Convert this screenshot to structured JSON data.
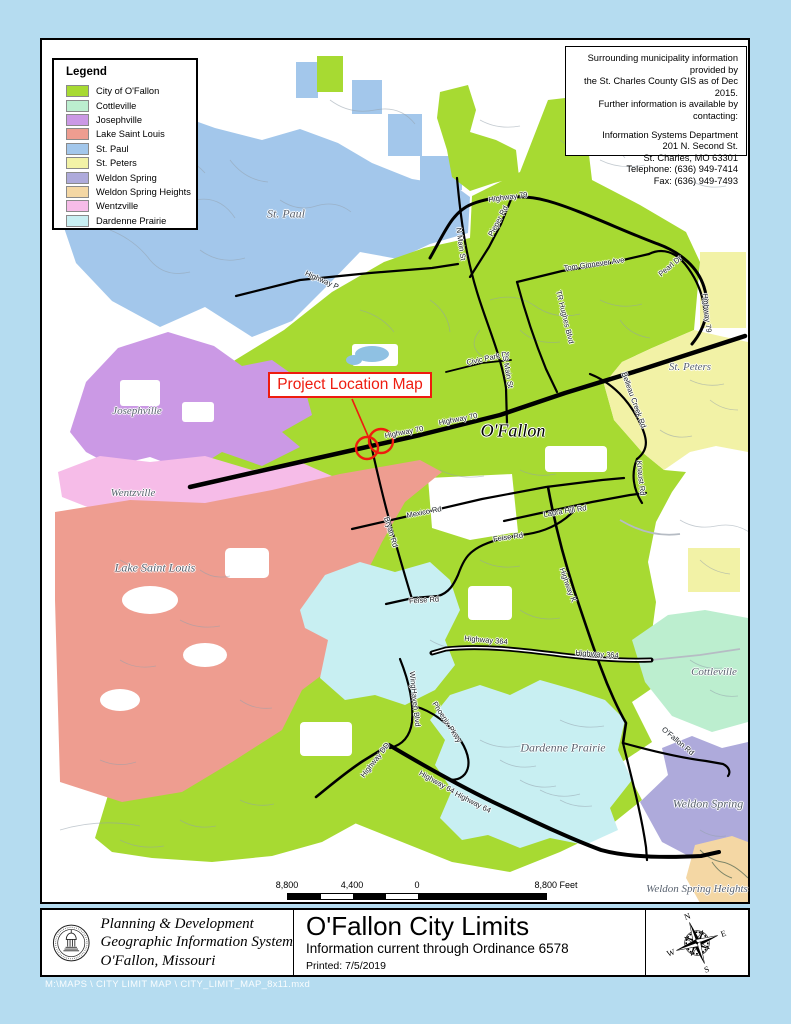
{
  "legend": {
    "title": "Legend",
    "items": [
      {
        "label": "City of O'Fallon",
        "color": "#a7da32"
      },
      {
        "label": "Cottleville",
        "color": "#bceecf"
      },
      {
        "label": "Josephville",
        "color": "#cb99e5"
      },
      {
        "label": "Lake Saint Louis",
        "color": "#ee9d90"
      },
      {
        "label": "St. Paul",
        "color": "#a3c7eb"
      },
      {
        "label": "St. Peters",
        "color": "#f2f2a6"
      },
      {
        "label": "Weldon Spring",
        "color": "#aeaadb"
      },
      {
        "label": "Weldon Spring Heights",
        "color": "#f4d7a4"
      },
      {
        "label": "Wentzville",
        "color": "#f6bce8"
      },
      {
        "label": "Dardenne Prairie",
        "color": "#c8eff2"
      }
    ]
  },
  "info_box": {
    "lines": [
      "Surrounding municipality information provided by",
      "the St. Charles County GIS as of Dec 2015.",
      "Further information is available by contacting:"
    ],
    "contact": [
      "Information Systems Department",
      "201 N. Second St.",
      "St. Charles, MO  63301",
      "Telephone: (636) 949-7414",
      "Fax: (636) 949-7493"
    ]
  },
  "callout": {
    "text": "Project Location Map"
  },
  "map": {
    "city_labels": [
      {
        "text": "St. Paul",
        "x": 286,
        "y": 214,
        "size": 12
      },
      {
        "text": "Josephville",
        "x": 137,
        "y": 411,
        "size": 11
      },
      {
        "text": "Wentzville",
        "x": 133,
        "y": 493,
        "size": 11
      },
      {
        "text": "Lake Saint Louis",
        "x": 155,
        "y": 568,
        "size": 12
      },
      {
        "text": "O'Fallon",
        "x": 513,
        "y": 431,
        "size": 18,
        "big": true
      },
      {
        "text": "St. Peters",
        "x": 690,
        "y": 367,
        "size": 11
      },
      {
        "text": "Cottleville",
        "x": 714,
        "y": 672,
        "size": 11
      },
      {
        "text": "Dardenne Prairie",
        "x": 563,
        "y": 748,
        "size": 12
      },
      {
        "text": "Weldon Spring",
        "x": 708,
        "y": 804,
        "size": 12
      },
      {
        "text": "Weldon Spring Heights",
        "x": 697,
        "y": 889,
        "size": 11
      }
    ],
    "road_labels": [
      {
        "text": "Highway 79",
        "x": 508,
        "y": 197,
        "rot": -8
      },
      {
        "text": "Highway 79",
        "x": 707,
        "y": 313,
        "rot": 84
      },
      {
        "text": "Highway P",
        "x": 322,
        "y": 280,
        "rot": 24
      },
      {
        "text": "N Main St",
        "x": 461,
        "y": 244,
        "rot": 82
      },
      {
        "text": "Pieper Rd",
        "x": 498,
        "y": 221,
        "rot": -62
      },
      {
        "text": "Tom Ginnever Ave",
        "x": 594,
        "y": 264,
        "rot": -8
      },
      {
        "text": "Pearl Dr",
        "x": 670,
        "y": 266,
        "rot": -40
      },
      {
        "text": "TR Hughes Blvd",
        "x": 565,
        "y": 317,
        "rot": 76
      },
      {
        "text": "Civic Park Dr",
        "x": 488,
        "y": 358,
        "rot": -12
      },
      {
        "text": "S Main St",
        "x": 508,
        "y": 372,
        "rot": 80
      },
      {
        "text": "Highway 70",
        "x": 404,
        "y": 432,
        "rot": -11
      },
      {
        "text": "Highway 70",
        "x": 458,
        "y": 419,
        "rot": -11
      },
      {
        "text": "Belleau Creek Rd",
        "x": 634,
        "y": 400,
        "rot": 70
      },
      {
        "text": "Knaust Rd",
        "x": 641,
        "y": 478,
        "rot": 84
      },
      {
        "text": "Mexico Rd",
        "x": 424,
        "y": 512,
        "rot": -11
      },
      {
        "text": "Laura Hill Rd",
        "x": 565,
        "y": 511,
        "rot": -9
      },
      {
        "text": "Bryan Rd",
        "x": 391,
        "y": 532,
        "rot": 73
      },
      {
        "text": "Feise Rd",
        "x": 508,
        "y": 537,
        "rot": -8
      },
      {
        "text": "Feise Rd",
        "x": 424,
        "y": 600,
        "rot": -4
      },
      {
        "text": "Highway K",
        "x": 568,
        "y": 585,
        "rot": 70
      },
      {
        "text": "Highway 364",
        "x": 486,
        "y": 640,
        "rot": 5
      },
      {
        "text": "Highway 364",
        "x": 597,
        "y": 654,
        "rot": 4
      },
      {
        "text": "WingHaven Blvd",
        "x": 415,
        "y": 699,
        "rot": 84
      },
      {
        "text": "Phoenix Pkwy",
        "x": 447,
        "y": 722,
        "rot": 57
      },
      {
        "text": "Highway DD",
        "x": 375,
        "y": 760,
        "rot": -52
      },
      {
        "text": "Highway 64",
        "x": 437,
        "y": 782,
        "rot": 29
      },
      {
        "text": "Highway 64",
        "x": 473,
        "y": 802,
        "rot": 27
      },
      {
        "text": "O'Fallon Rd",
        "x": 678,
        "y": 741,
        "rot": 40
      }
    ]
  },
  "scale_bar": {
    "left": "8,800",
    "mid": "4,400",
    "zero": "0",
    "right": "8,800 Feet"
  },
  "footer": {
    "org_lines": [
      "Planning & Development",
      "Geographic Information System",
      "O'Fallon, Missouri"
    ],
    "title": "O'Fallon City Limits",
    "subtitle": "Information current through Ordinance 6578",
    "printed": "Printed: 7/5/2019"
  },
  "compass": {
    "n": "N",
    "e": "E",
    "s": "S",
    "w": "W"
  },
  "file_path": "M:\\MAPS \\ CITY LIMIT MAP \\ CITY_LIMIT_MAP_8x11.mxd",
  "colors": {
    "callout_red": "#ee1c0f",
    "road_black": "#000000",
    "page_blue": "#b5dcf0"
  }
}
